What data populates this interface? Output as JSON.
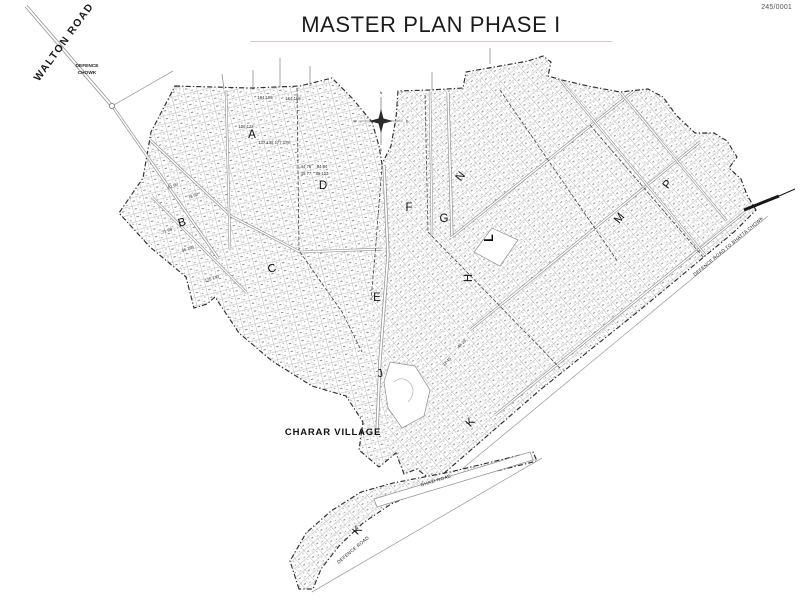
{
  "page": {
    "title": "MASTER PLAN PHASE I",
    "doc_number": "245/0001"
  },
  "map": {
    "labels": {
      "walton_road": "WALTON ROAD",
      "defence_chowk_line1": "DEFENCE",
      "defence_chowk_line2": "CHOWK",
      "charar_village": "CHARAR VILLAGE",
      "defence_road_to_bhatta_chowk": "DEFENCE ROAD TO BHATTA CHOWK",
      "defence_road": "DEFENCE ROAD",
      "ghazi_road": "GHAZI ROAD"
    },
    "compass": {
      "north": "N",
      "south": "S",
      "east": "E",
      "west": "W"
    },
    "sectors": [
      {
        "label": "A"
      },
      {
        "label": "B"
      },
      {
        "label": "C"
      },
      {
        "label": "D"
      },
      {
        "label": "E"
      },
      {
        "label": "F"
      },
      {
        "label": "G"
      },
      {
        "label": "H"
      },
      {
        "label": "J"
      },
      {
        "label": "K"
      },
      {
        "label": "K"
      },
      {
        "label": "L"
      },
      {
        "label": "M"
      },
      {
        "label": "N"
      },
      {
        "label": "P"
      }
    ],
    "plot_numbers": [
      "104 105",
      "164 166",
      "108 122",
      "137 138 177 178",
      "44 76",
      "48 77",
      "84 84",
      "86 123",
      "61 60",
      "79 80",
      "71 88",
      "66 106",
      "125 143",
      "22 45",
      "48 23"
    ],
    "colors": {
      "ink": "#1f1f1f",
      "grid_line": "#a8a8a8",
      "paper": "#ffffff"
    }
  }
}
